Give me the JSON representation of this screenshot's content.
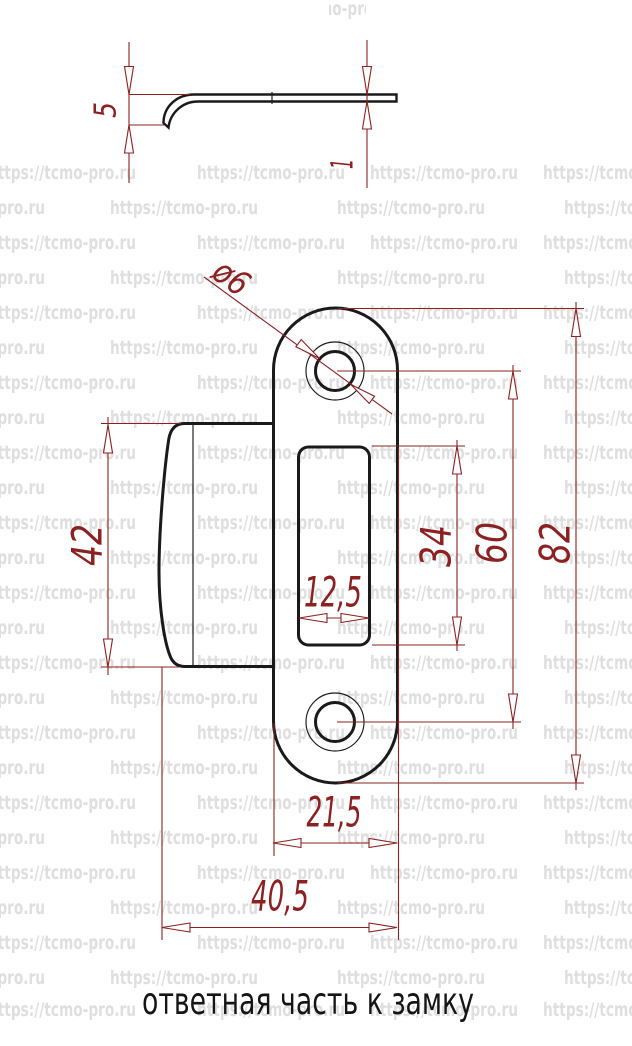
{
  "watermark": {
    "text": "https://tcmo-pro.ru",
    "color": "#e0dfdf"
  },
  "caption": "ответная часть к замку",
  "colors": {
    "outline": "#1a1a1a",
    "dimension_red": "#8b2121",
    "background": "#ffffff"
  },
  "side_view": {
    "dims": {
      "lip_height": "5",
      "plate_thickness": "1"
    }
  },
  "front_view": {
    "dims": {
      "hole_diameter": "ø6",
      "tab_height": "42",
      "slot_height": "34",
      "holes_spacing": "60",
      "plate_height": "82",
      "slot_width": "12,5",
      "body_width": "21,5",
      "overall_width": "40,5"
    }
  }
}
